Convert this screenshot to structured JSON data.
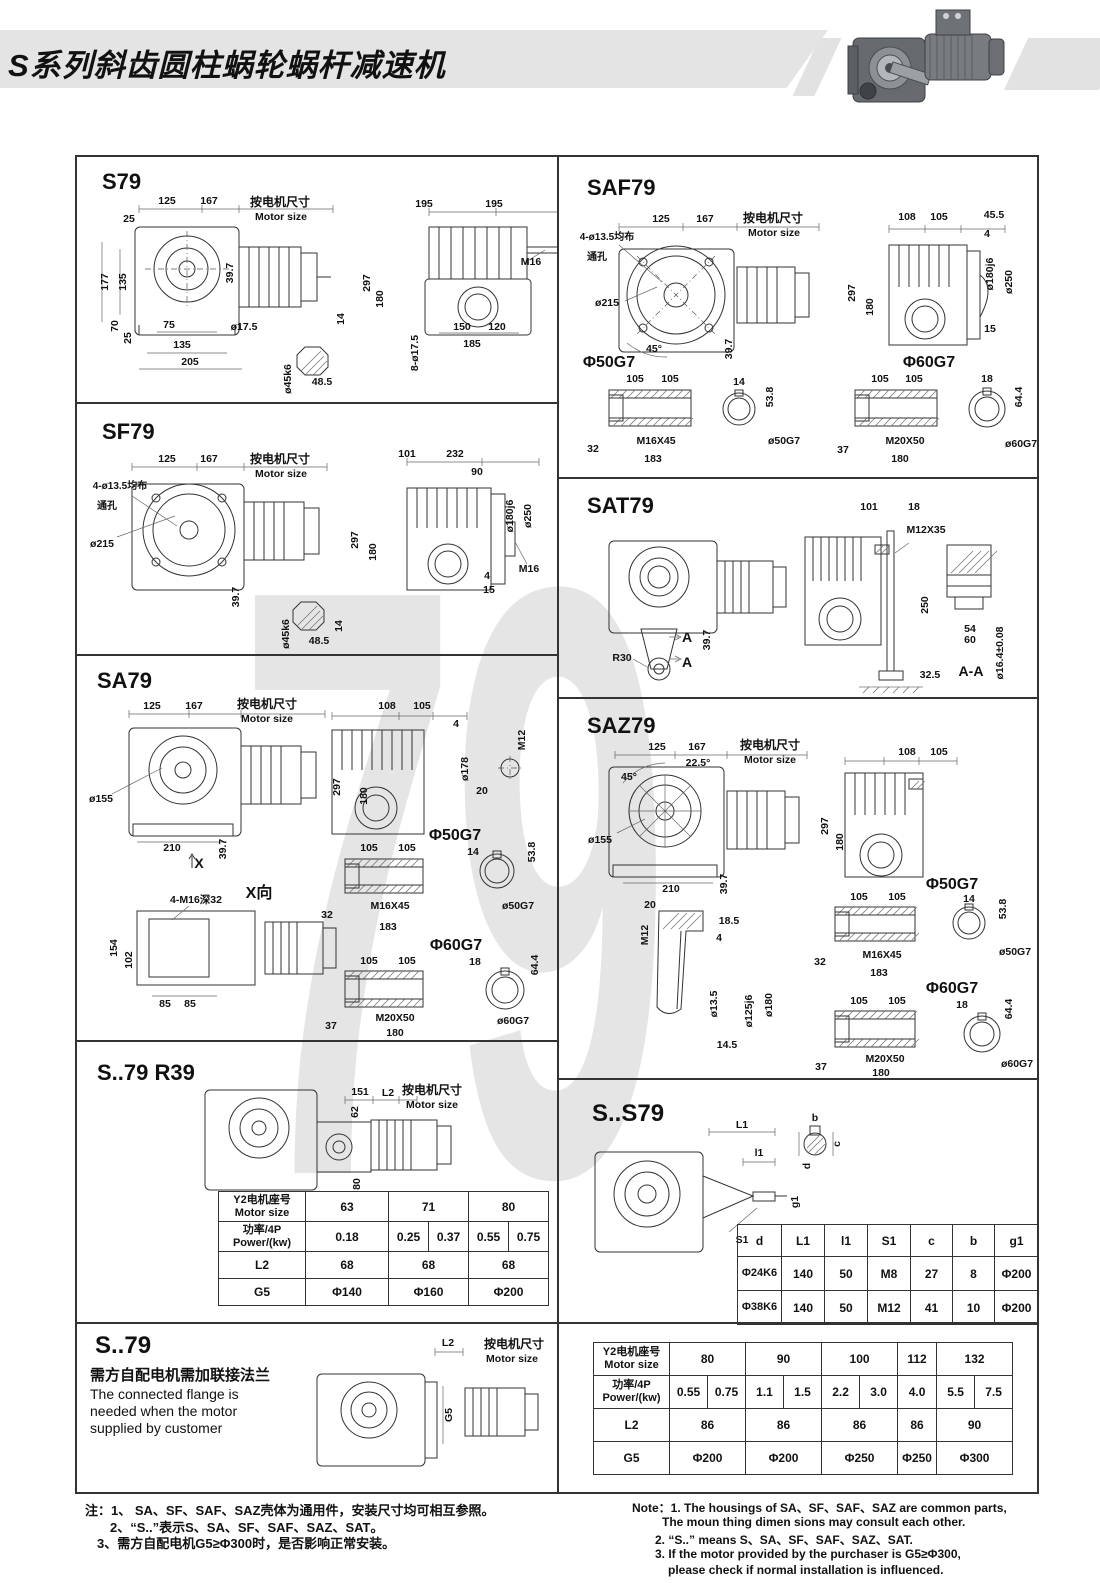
{
  "header": {
    "title": "S系列斜齿圆柱蜗轮蜗杆减速机"
  },
  "watermark": "79",
  "s79": {
    "title": "S79",
    "dims": [
      "125",
      "167",
      "按电机尺寸",
      "Motor size",
      "25",
      "177",
      "135",
      "39.7",
      "70",
      "25",
      "75",
      "135",
      "205",
      "ø17.5",
      "14",
      "48.5",
      "ø45k6",
      "195",
      "195",
      "297",
      "180",
      "M16",
      "150",
      "120",
      "185",
      "8-ø17.5"
    ]
  },
  "sf79": {
    "title": "SF79",
    "dims": [
      "125",
      "167",
      "按电机尺寸",
      "Motor size",
      "4-ø13.5均布",
      "通孔",
      "ø215",
      "39.7",
      "101",
      "232",
      "90",
      "297",
      "180",
      "ø180j6",
      "ø250",
      "4",
      "15",
      "M16",
      "ø45k6",
      "48.5",
      "14"
    ]
  },
  "sa79": {
    "title": "SA79",
    "dims": [
      "125",
      "167",
      "按电机尺寸",
      "Motor size",
      "ø155",
      "210",
      "39.7",
      "X",
      "108",
      "105",
      "4",
      "297",
      "180",
      "ø178",
      "M12",
      "20",
      "Φ50G7",
      "105",
      "105",
      "14",
      "53.8",
      "32",
      "M16X45",
      "183",
      "ø50G7",
      "Φ60G7",
      "105",
      "105",
      "18",
      "64.4",
      "37",
      "M20X50",
      "180",
      "ø60G7",
      "4-M16深32",
      "X向",
      "154",
      "102",
      "85",
      "85"
    ]
  },
  "saf79": {
    "title": "SAF79",
    "dims": [
      "125",
      "167",
      "按电机尺寸",
      "Motor size",
      "4-ø13.5均布",
      "通孔",
      "ø215",
      "45°",
      "39.7",
      "108",
      "105",
      "45.5",
      "4",
      "297",
      "180",
      "ø180j6",
      "ø250",
      "15",
      "Φ50G7",
      "105",
      "105",
      "14",
      "53.8",
      "32",
      "M16X45",
      "183",
      "ø50G7",
      "Φ60G7",
      "105",
      "105",
      "18",
      "64.4",
      "37",
      "M20X50",
      "180",
      "ø60G7"
    ]
  },
  "sat79": {
    "title": "SAT79",
    "dims": [
      "101",
      "18",
      "M12X35",
      "R30",
      "A",
      "A",
      "39.7",
      "250",
      "32.5",
      "54",
      "60",
      "ø16.4±0.08",
      "A-A"
    ]
  },
  "saz79": {
    "title": "SAZ79",
    "dims": [
      "125",
      "167",
      "22.5°",
      "按电机尺寸",
      "Motor size",
      "45°",
      "ø155",
      "210",
      "39.7",
      "108",
      "105",
      "297",
      "180",
      "Φ50G7",
      "105",
      "105",
      "14",
      "53.8",
      "20",
      "M12",
      "18.5",
      "4",
      "ø13.5",
      "ø125j6",
      "ø180",
      "14.5",
      "32",
      "M16X45",
      "183",
      "ø50G7",
      "Φ60G7",
      "105",
      "105",
      "18",
      "64.4",
      "37",
      "M20X50",
      "180",
      "ø60G7"
    ]
  },
  "r39": {
    "title": "S..79  R39",
    "dims": [
      "151",
      "L2",
      "按电机尺寸",
      "Motor size",
      "62",
      "80"
    ],
    "table": {
      "motor_label": [
        "Y2电机座号",
        "Motor size"
      ],
      "sizes": [
        "63",
        "71",
        "80"
      ],
      "power_label": [
        "功率/4P",
        "Power/(kw)"
      ],
      "powers": [
        "0.18",
        "0.25",
        "0.37",
        "0.55",
        "0.75"
      ],
      "l2_label": "L2",
      "l2": [
        "68",
        "68",
        "68"
      ],
      "g5_label": "G5",
      "g5": [
        "Φ140",
        "Φ160",
        "Φ200"
      ]
    }
  },
  "ss79": {
    "title": "S..S79",
    "dims": [
      "L1",
      "l1",
      "g1",
      "S1",
      "b",
      "c",
      "d"
    ],
    "table": {
      "headers": [
        "d",
        "L1",
        "l1",
        "S1",
        "c",
        "b",
        "g1"
      ],
      "rows": [
        [
          "Φ24K6",
          "140",
          "50",
          "M8",
          "27",
          "8",
          "Φ200"
        ],
        [
          "Φ38K6",
          "140",
          "50",
          "M12",
          "41",
          "10",
          "Φ200"
        ]
      ]
    }
  },
  "s79b": {
    "title": "S..79",
    "note_cn": "需方自配电机需加联接法兰",
    "note_en": [
      "The connected flange is",
      "needed when  the motor",
      "supplied by customer"
    ],
    "dims": [
      "L2",
      "按电机尺寸",
      "Motor size",
      "G5"
    ]
  },
  "btable": {
    "motor_label": [
      "Y2电机座号",
      "Motor size"
    ],
    "sizes": [
      "80",
      "90",
      "100",
      "112",
      "132"
    ],
    "power_label": [
      "功率/4P",
      "Power/(kw)"
    ],
    "powers": [
      "0.55",
      "0.75",
      "1.1",
      "1.5",
      "2.2",
      "3.0",
      "4.0",
      "5.5",
      "7.5"
    ],
    "l2_label": "L2",
    "l2": [
      "86",
      "86",
      "86",
      "86",
      "90"
    ],
    "g5_label": "G5",
    "g5": [
      "Φ200",
      "Φ200",
      "Φ250",
      "Φ250",
      "Φ300"
    ]
  },
  "notes": {
    "cn": [
      "注：1、 SA、SF、SAF、SAZ壳体为通用件，安装尺寸均可相互参照。",
      "2、“S..”表示S、SA、SF、SAF、SAZ、SAT。",
      "3、需方自配电机G5≥Φ300时，是否影响正常安装。"
    ],
    "en": [
      "Note：1. The housings of SA、SF、SAF、SAZ are common parts,",
      "The moun thing dimen sions may consult each other.",
      "2. “S..” means S、SA、SF、SAF、SAZ、SAT.",
      "3. If the motor provided by the purchaser is G5≥Φ300,",
      "please check if normal installation is influenced."
    ]
  }
}
